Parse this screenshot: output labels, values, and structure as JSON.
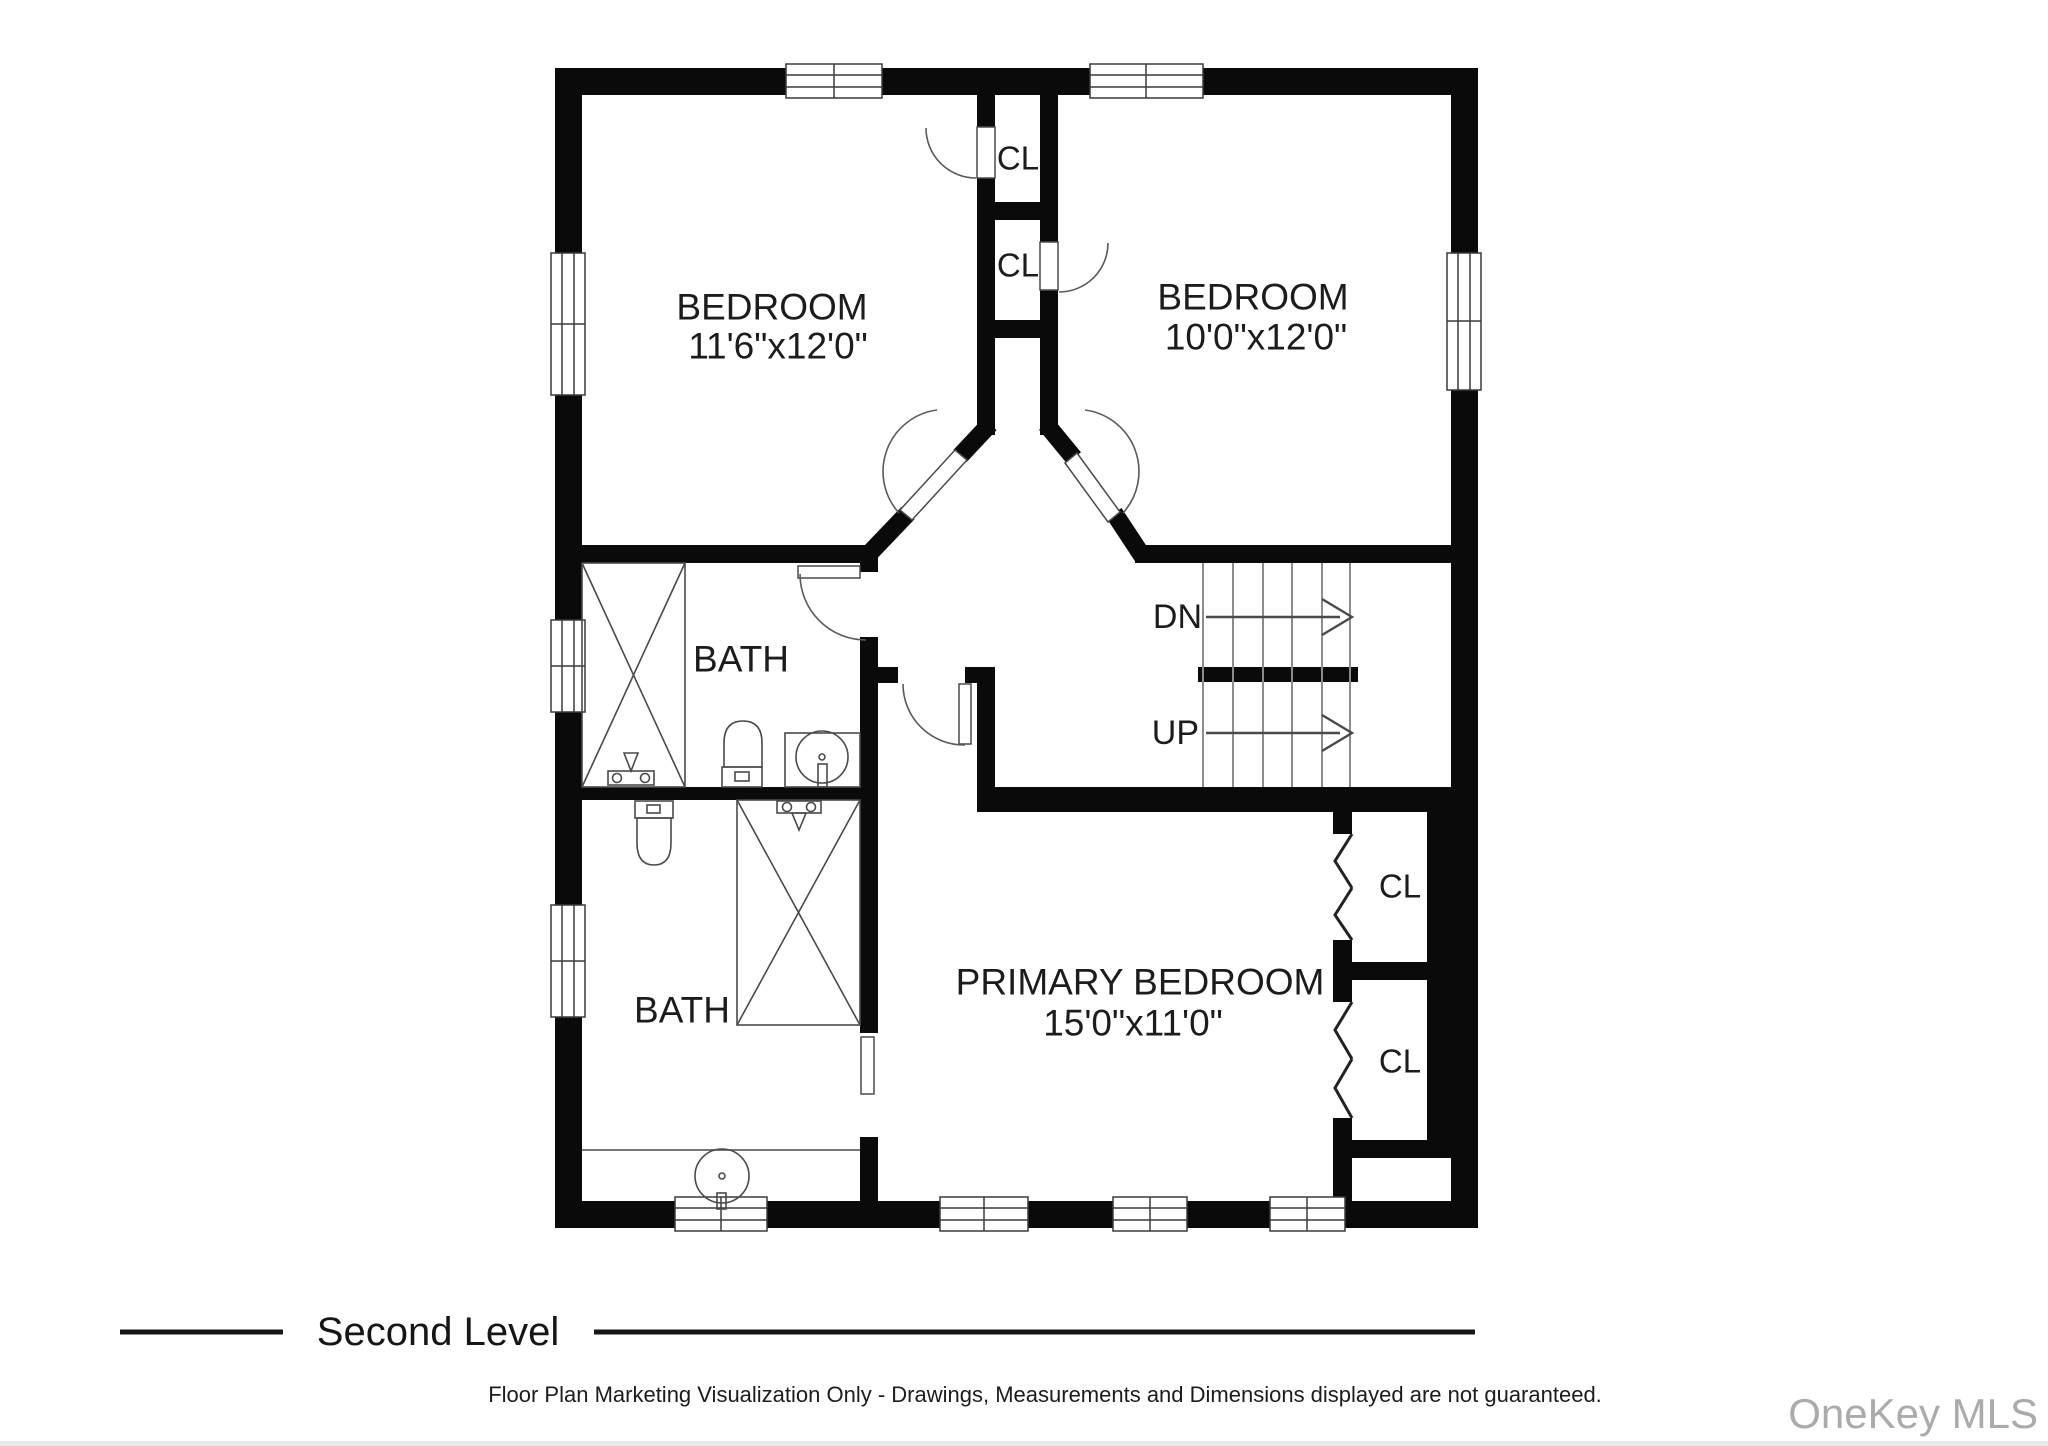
{
  "plan": {
    "rooms": {
      "bedroom_left": {
        "label": "BEDROOM",
        "dims": "11'6\"x12'0\""
      },
      "bedroom_right": {
        "label": "BEDROOM",
        "dims": "10'0\"x12'0\""
      },
      "bath_middle": {
        "label": "BATH"
      },
      "bath_lower": {
        "label": "BATH"
      },
      "primary_bedroom": {
        "label": "PRIMARY BEDROOM",
        "dims": "15'0\"x11'0\""
      }
    },
    "closets": {
      "hall_upper": "CL",
      "hall_lower": "CL",
      "primary_upper": "CL",
      "primary_lower": "CL"
    },
    "stairs": {
      "down_label": "DN",
      "up_label": "UP"
    }
  },
  "footer": {
    "level_label": "Second Level",
    "disclaimer": "Floor Plan Marketing Visualization Only - Drawings, Measurements and Dimensions displayed are not guaranteed.",
    "watermark": "OneKey MLS"
  },
  "colors": {
    "wall": "#0a0a0a",
    "background": "#ffffff",
    "fixture_stroke": "#4a4a4a",
    "watermark": "#ababab",
    "text": "#1c1c1c",
    "bottom_strip": "#e8e8e8"
  }
}
